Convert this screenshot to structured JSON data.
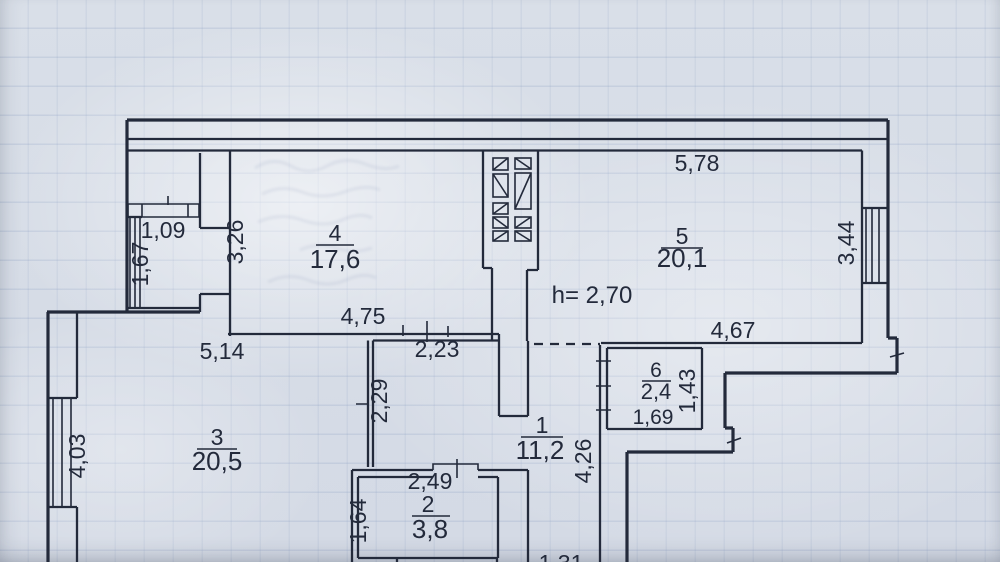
{
  "colors": {
    "paper": "#d9dfe8",
    "ink": "#232a3b",
    "grid": "#7e94bc"
  },
  "plan": {
    "rooms": [
      {
        "key": "room-1",
        "number": "1",
        "area": "11,2"
      },
      {
        "key": "room-2",
        "number": "2",
        "area": "3,8"
      },
      {
        "key": "room-3",
        "number": "3",
        "area": "20,5"
      },
      {
        "key": "room-4",
        "number": "4",
        "area": "17,6"
      },
      {
        "key": "room-5",
        "number": "5",
        "area": "20,1"
      },
      {
        "key": "room-6",
        "number": "6",
        "area": "2,4"
      }
    ],
    "height_note": "h= 2,70",
    "dims": {
      "d109": "1,09",
      "d167": "1,67",
      "d326": "3,26",
      "d578": "5,78",
      "d344": "3,44",
      "d475": "4,75",
      "d223": "2,23",
      "d514": "5,14",
      "d403": "4,03",
      "d229": "2,29",
      "d467": "4,67",
      "d143": "1,43",
      "d426": "4,26",
      "d249": "2,49",
      "d164": "1,64",
      "d169": "1,69",
      "d131": "1,31"
    }
  }
}
